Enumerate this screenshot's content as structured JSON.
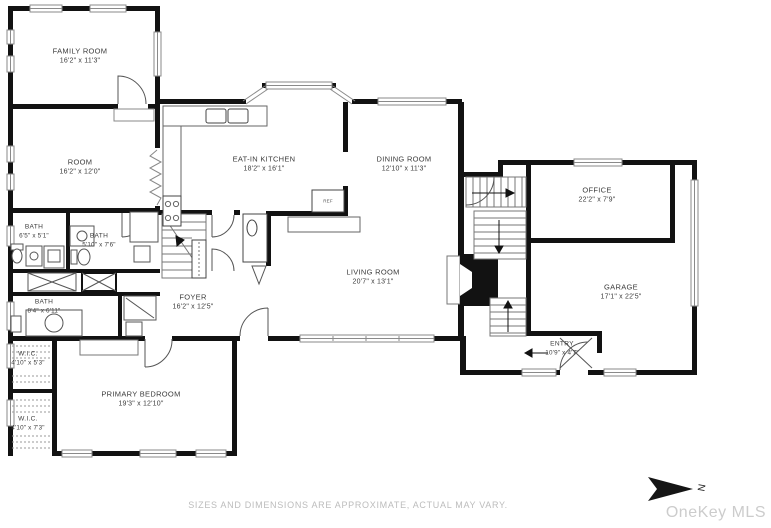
{
  "rooms": [
    {
      "id": "family-room",
      "name": "FAMILY ROOM",
      "dims": "16'2\" x 11'3\""
    },
    {
      "id": "room",
      "name": "ROOM",
      "dims": "16'2\" x 12'0\""
    },
    {
      "id": "eat-in-kitchen",
      "name": "EAT-IN KITCHEN",
      "dims": "18'2\" x 16'1\""
    },
    {
      "id": "dining-room",
      "name": "DINING ROOM",
      "dims": "12'10\" x 11'3\""
    },
    {
      "id": "office",
      "name": "OFFICE",
      "dims": "22'2\" x 7'9\""
    },
    {
      "id": "garage",
      "name": "GARAGE",
      "dims": "17'1\" x 22'5\""
    },
    {
      "id": "living-room",
      "name": "LIVING ROOM",
      "dims": "20'7\" x 13'1\""
    },
    {
      "id": "foyer",
      "name": "FOYER",
      "dims": "16'2\" x 12'5\""
    },
    {
      "id": "bath-upper-left",
      "name": "BATH",
      "dims": "6'5\" x 5'1\""
    },
    {
      "id": "bath-upper-right",
      "name": "BATH",
      "dims": "5'10\" x 7'6\""
    },
    {
      "id": "bath-lower",
      "name": "BATH",
      "dims": "8'4\" x 6'11\""
    },
    {
      "id": "wic-upper",
      "name": "W.I.C.",
      "dims": "4'10\" x 5'3\""
    },
    {
      "id": "wic-lower",
      "name": "W.I.C.",
      "dims": "4'10\" x 7'3\""
    },
    {
      "id": "primary-bedroom",
      "name": "PRIMARY BEDROOM",
      "dims": "19'3\" x 12'10\""
    },
    {
      "id": "entry",
      "name": "ENTRY",
      "dims": "10'9\" x 4'7\""
    }
  ],
  "kitchen": {
    "fridge_label": "REF"
  },
  "footer": {
    "disclaimer": "SIZES AND DIMENSIONS ARE APPROXIMATE, ACTUAL MAY VARY."
  },
  "watermark": {
    "text": "OneKey MLS"
  },
  "compass": {
    "label": "N"
  },
  "colors": {
    "wall": "#121212",
    "window_line": "#8a8a8a",
    "label_text": "#3c3c3c",
    "muted_text": "#bcbcbc",
    "watermark": "#cccccc"
  }
}
